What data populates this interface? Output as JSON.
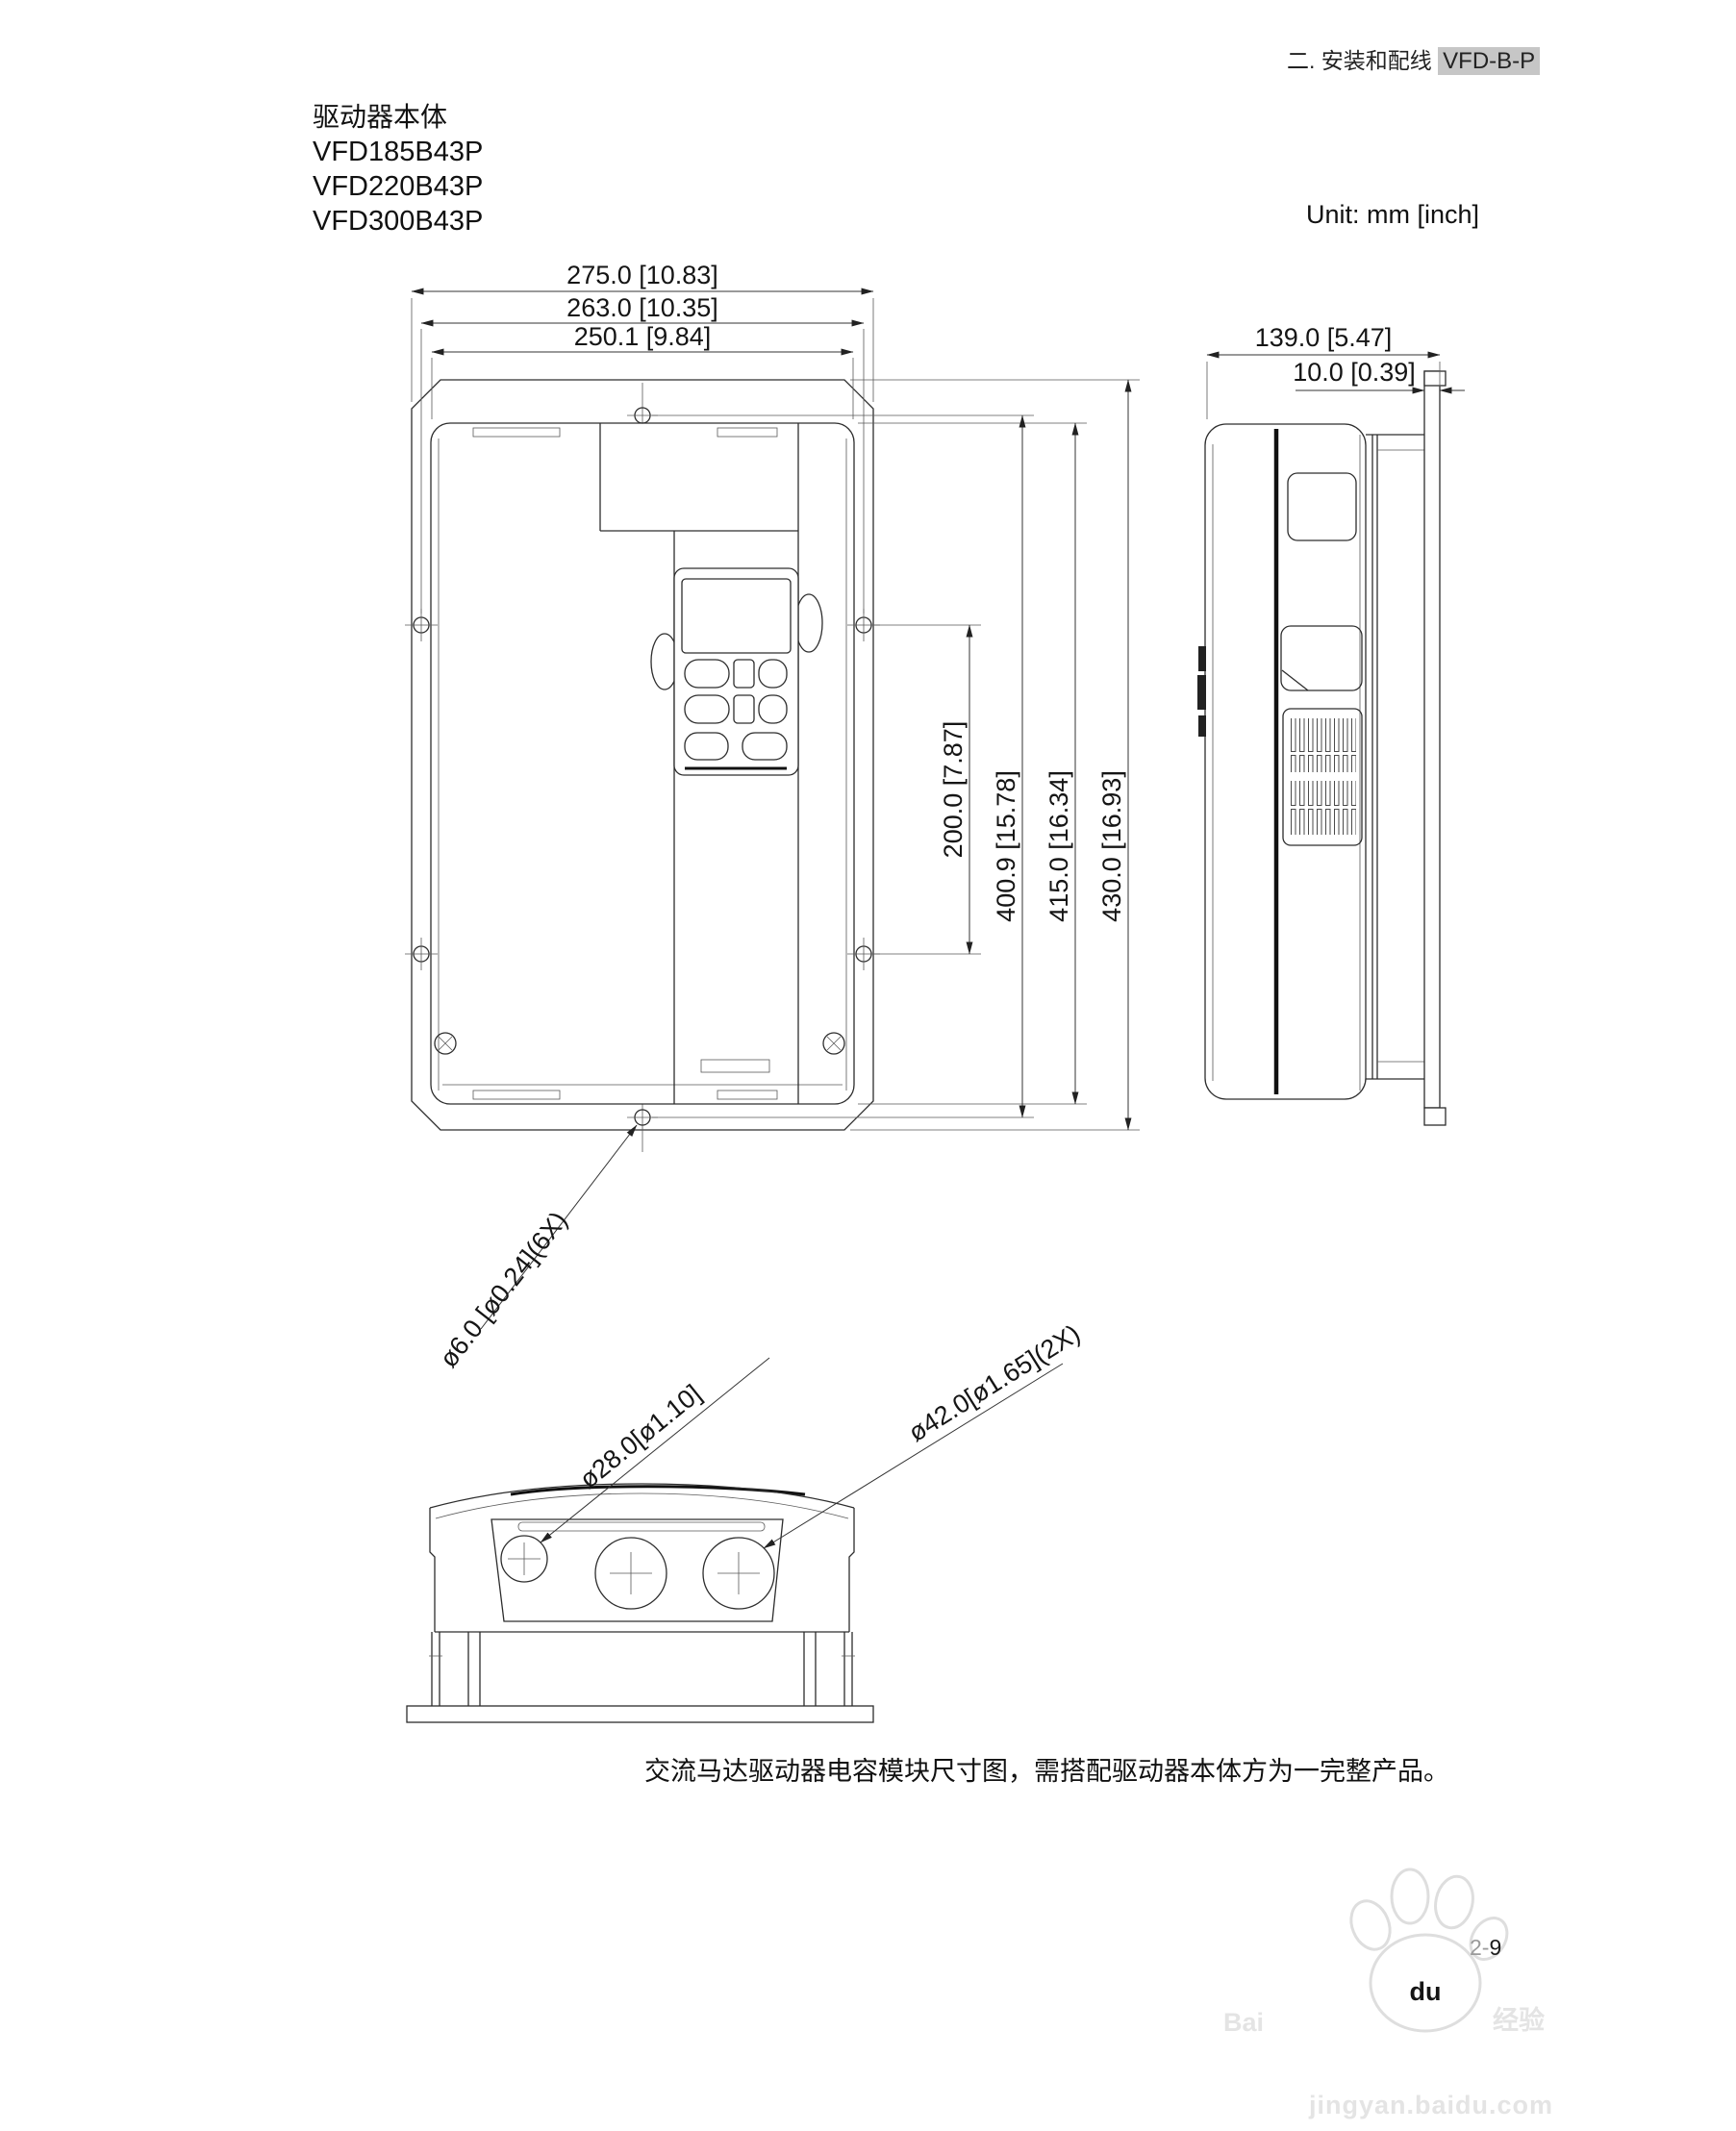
{
  "page": {
    "header_section": "二. 安装和配线",
    "header_model": "VFD-B-P",
    "unit_label": "Unit: mm [inch]",
    "caption": "交流马达驱动器电容模块尺寸图，需搭配驱动器本体方为一完整产品。",
    "page_number_prefix": "2-",
    "page_number_suffix": "9"
  },
  "title_block": {
    "product": "驱动器本体",
    "model_1": "VFD185B43P",
    "model_2": "VFD220B43P",
    "model_3": "VFD300B43P"
  },
  "front_view": {
    "dim_width_plate": "275.0 [10.83]",
    "dim_width_holes": "263.0 [10.35]",
    "dim_width_body": "250.1 [9.84]",
    "dim_height_side_holes": "200.0 [7.87]",
    "dim_height_holes": "400.9 [15.78]",
    "dim_height_body": "415.0 [16.34]",
    "dim_height_plate": "430.0 [16.93]",
    "leader_holes": "ø6.0 [ø0.24](6X)"
  },
  "side_view": {
    "dim_depth": "139.0 [5.47]",
    "dim_plate": "10.0 [0.39]"
  },
  "bottom_view": {
    "leader_small_hole": "ø28.0[ø1.10]",
    "leader_large_hole": "ø42.0[ø1.65](2X)"
  },
  "watermark": {
    "brand": "Bai",
    "brand_du": "du",
    "brand_cn": "经验",
    "url": "jingyan.baidu.com"
  }
}
